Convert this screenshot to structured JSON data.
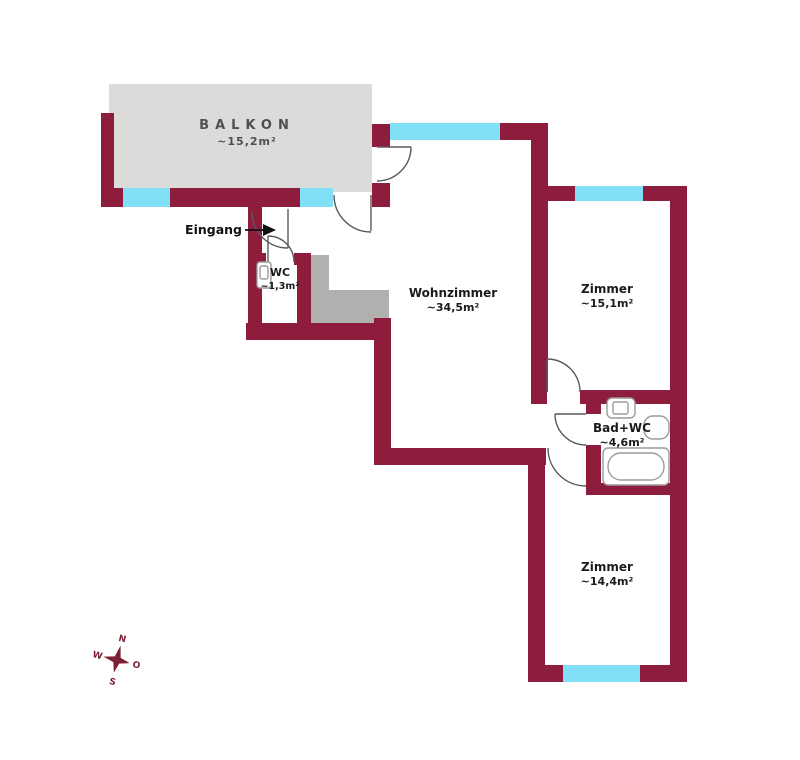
{
  "floorplan": {
    "rooms": [
      {
        "id": "balkon",
        "name": "BALKON",
        "area": "~15,2m²"
      },
      {
        "id": "wc",
        "name": "WC",
        "area": "~1,3m²"
      },
      {
        "id": "wohnzimmer",
        "name": "Wohnzimmer",
        "area": "~34,5m²"
      },
      {
        "id": "zimmer-1",
        "name": "Zimmer",
        "area": "~15,1m²"
      },
      {
        "id": "bad-wc",
        "name": "Bad+WC",
        "area": "~4,6m²"
      },
      {
        "id": "zimmer-2",
        "name": "Zimmer",
        "area": "~14,4m²"
      }
    ],
    "entrance": {
      "label": "Eingang"
    },
    "compass": {
      "north": "N",
      "east": "O",
      "south": "S",
      "west": "W"
    },
    "colors": {
      "wall": "#8e1c3c",
      "window": "#82e0f6",
      "balcony_floor": "#dbdbd9",
      "stair_block": "#b0b0ae",
      "door_stroke": "#5a5a5a",
      "fixture_stroke": "#9b9b9b",
      "text_dark": "#1b1b1b",
      "text_gray": "#4f4f4f",
      "compass": "#7c2034"
    }
  }
}
